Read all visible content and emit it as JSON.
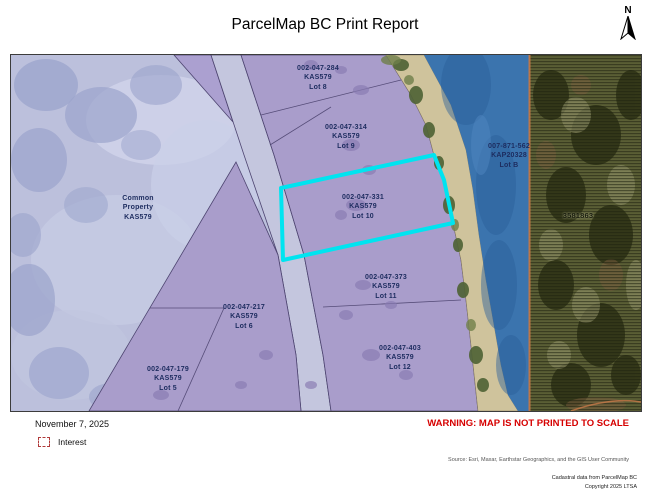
{
  "title": "ParcelMap BC Print Report",
  "north_indicator": {
    "label": "N"
  },
  "map": {
    "parcels": [
      {
        "pid": "002-047-284",
        "plan": "KAS579",
        "lot": "Lot 8"
      },
      {
        "pid": "002-047-314",
        "plan": "KAS579",
        "lot": "Lot 9"
      },
      {
        "pid": "002-047-331",
        "plan": "KAS579",
        "lot": "Lot 10"
      },
      {
        "pid": "007-871-562",
        "plan": "KAP20328",
        "lot": "Lot B"
      },
      {
        "pid": "002-047-373",
        "plan": "KAS579",
        "lot": "Lot 11"
      },
      {
        "pid": "002-047-217",
        "plan": "KAS579",
        "lot": "Lot 6"
      },
      {
        "pid": "002-047-403",
        "plan": "KAS579",
        "lot": "Lot 12"
      },
      {
        "pid": "002-047-179",
        "plan": "KAS579",
        "lot": "Lot 5"
      }
    ],
    "common_property": [
      "Common",
      "Property",
      "KAS579"
    ],
    "crown_parcel_label": "3581863"
  },
  "footer": {
    "date": "November 7, 2025",
    "legend_label": "Interest",
    "warning": "WARNING: MAP IS NOT PRINTED TO SCALE",
    "source": "Source: Esri, Maxar, Earthstar Geographics, and the GIS User Community",
    "copyright_line1": "Cadastral data from ParcelMap BC",
    "copyright_line2": "Copyright 2025 LTSA"
  },
  "colors": {
    "interest_highlight": "#00e4f0",
    "warning_red": "#d60000",
    "legend_red": "#b03a3a",
    "parcel_purple": "#a99dcb",
    "water_blue": "#3b74ae"
  }
}
